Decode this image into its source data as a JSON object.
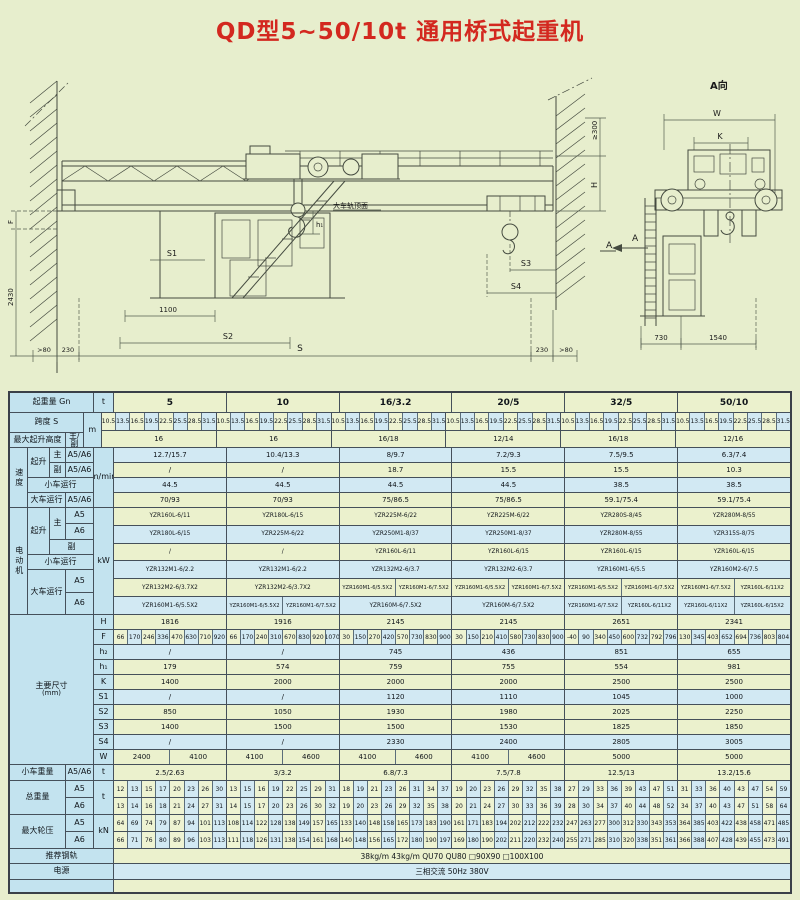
{
  "title": "QD型5~50/10t 通用桥式起重机",
  "drawing": {
    "main": {
      "f": "F",
      "v2430": "2430",
      "s1": "S1",
      "v1100": "1100",
      "s2": "S2",
      "gt80L": ">80",
      "v230L": "230",
      "span": "S",
      "v230R": "230",
      "gt80R": ">80",
      "ge300": "≥300",
      "h": "H",
      "h1": "h₁",
      "s3": "S3",
      "s4": "S4",
      "railTop": "大车轨顶面",
      "arrowA": "A"
    },
    "side": {
      "title": "A向",
      "w": "W",
      "k": "K",
      "v730": "730",
      "v1540": "1540",
      "a": "A"
    }
  },
  "table": {
    "labels": {
      "capacity": "起重量 Gn",
      "span": "跨度 S",
      "liftHeight": "最大起升高度",
      "mainAux": "主/副",
      "speedGroup": "速度",
      "hoist": "起升",
      "main": "主",
      "aux": "副",
      "a5a6": "A5/A6",
      "trolleyRun": "小车运行",
      "craneRun": "大车运行",
      "motorGroup": "电动机",
      "a5": "A5",
      "a6": "A6",
      "dimsGroup": "主要尺寸",
      "dimsUnit": "(mm)",
      "dims": [
        "H",
        "F",
        "h₂",
        "h₁",
        "K",
        "S1",
        "S2",
        "S3",
        "S4",
        "W"
      ],
      "trolleyWeight": "小车重量",
      "totalWeight": "总重量",
      "wheelLoad": "最大轮压",
      "rail": "推荐钢轨",
      "power": "电源"
    },
    "units": {
      "capacity": "t",
      "span": "m",
      "speed": "m/min",
      "motor": "kW",
      "trolleyWeight": "t",
      "totalWeight": "t",
      "wheelLoad": "kN"
    },
    "col_headers": [
      "5",
      "10",
      "16/3.2",
      "20/5",
      "32/5",
      "50/10"
    ],
    "spans": [
      [
        "10.5",
        "13.5",
        "16.5",
        "19.5",
        "22.5",
        "25.5",
        "28.5",
        "31.5"
      ],
      [
        "10.5",
        "13.5",
        "16.5",
        "19.5",
        "22.5",
        "25.5",
        "28.5",
        "31.5"
      ],
      [
        "10.5",
        "13.5",
        "16.5",
        "19.5",
        "22.5",
        "25.5",
        "28.5",
        "31.5"
      ],
      [
        "10.5",
        "13.5",
        "16.5",
        "19.5",
        "22.5",
        "25.5",
        "28.5",
        "31.5"
      ],
      [
        "10.5",
        "13.5",
        "16.5",
        "19.5",
        "22.5",
        "25.5",
        "28.5",
        "31.5"
      ],
      [
        "10.5",
        "13.5",
        "16.5",
        "19.5",
        "22.5",
        "25.5",
        "28.5",
        "31.5"
      ]
    ],
    "lift_height": [
      "16",
      "16",
      "16/18",
      "12/14",
      "16/18",
      "12/16"
    ],
    "speed_main": [
      "12.7/15.7",
      "10.4/13.3",
      "8/9.7",
      "7.2/9.3",
      "7.5/9.5",
      "6.3/7.4"
    ],
    "speed_aux": [
      "/",
      "/",
      "18.7",
      "15.5",
      "15.5",
      "10.3"
    ],
    "speed_trolley": [
      "44.5",
      "44.5",
      "44.5",
      "44.5",
      "38.5",
      "38.5"
    ],
    "speed_crane": [
      "70/93",
      "70/93",
      "75/86.5",
      "75/86.5",
      "59.1/75.4",
      "59.1/75.4"
    ],
    "motor_main_a5": [
      "YZR160L-6/11",
      "YZR180L-6/15",
      "YZR225M-6/22",
      "YZR225M-6/22",
      "YZR280S-8/45",
      "YZR280M-8/55"
    ],
    "motor_main_a6": [
      "YZR180L-6/15",
      "YZR225M-6/22",
      "YZR250M1-8/37",
      "YZR250M1-8/37",
      "YZR280M-8/55",
      "YZR315S-8/75"
    ],
    "motor_aux": [
      "/",
      "/",
      "YZR160L-6/11",
      "YZR160L-6/15",
      "YZR160L-6/15",
      "YZR160L-6/15"
    ],
    "motor_trolley": [
      "YZR132M1-6/2.2",
      "YZR132M1-6/2.2",
      "YZR132M2-6/3.7",
      "YZR132M2-6/3.7",
      "YZR160M1-6/5.5",
      "YZR160M2-6/7.5"
    ],
    "motor_crane_a5": [
      "YZR132M2-6/3.7X2",
      "YZR132M2-6/3.7X2",
      [
        "YZR160M1-6/5.5X2",
        "YZR160M1-6/7.5X2"
      ],
      [
        "YZR160M1-6/5.5X2",
        "YZR160M1-6/7.5X2"
      ],
      [
        "YZR160M1-6/5.5X2",
        "YZR160M1-6/7.5X2"
      ],
      [
        "YZR160M1-6/7.5X2",
        "YZR160L-6/11X2"
      ]
    ],
    "motor_crane_a6": [
      "YZR160M1-6/5.5X2",
      [
        "YZR160M1-6/5.5X2",
        "YZR160M1-6/7.5X2"
      ],
      "YZR160M-6/7.5X2",
      "YZR160M-6/7.5X2",
      [
        "YZR160M1-6/7.5X2",
        "YZR160L-6/11X2"
      ],
      [
        "YZR160L-6/11X2",
        "YZR160L-6/15X2"
      ]
    ],
    "dims": [
      [
        "1816",
        "1916",
        "2145",
        "2145",
        "2651",
        "2341"
      ],
      [
        [
          "66",
          "170",
          "246",
          "336",
          "470",
          "630",
          "710",
          "920"
        ],
        [
          "66",
          "170",
          "240",
          "310",
          "670",
          "830",
          "920",
          "1070"
        ],
        [
          "30",
          "150",
          "270",
          "420",
          "570",
          "730",
          "830",
          "900"
        ],
        [
          "30",
          "150",
          "210",
          "410",
          "580",
          "730",
          "830",
          "900"
        ],
        [
          "-40",
          "90",
          "340",
          "450",
          "600",
          "732",
          "792",
          "796"
        ],
        [
          "130",
          "345",
          "403",
          "652",
          "694",
          "736",
          "803",
          "804"
        ]
      ],
      [
        "/",
        "/",
        "745",
        "436",
        "851",
        "655"
      ],
      [
        "179",
        "574",
        "759",
        "755",
        "554",
        "981"
      ],
      [
        "1400",
        "2000",
        "2000",
        "2000",
        "2500",
        "2500"
      ],
      [
        "/",
        "/",
        "1120",
        "1110",
        "1045",
        "1000"
      ],
      [
        "850",
        "1050",
        "1930",
        "1980",
        "2025",
        "2250"
      ],
      [
        "1400",
        "1500",
        "1500",
        "1530",
        "1825",
        "1850"
      ],
      [
        "/",
        "/",
        "2330",
        "2400",
        "2805",
        "3005"
      ],
      [
        [
          "2400",
          "4100"
        ],
        [
          "4100",
          "4600"
        ],
        [
          "4100",
          "4600"
        ],
        [
          "4100",
          "4600"
        ],
        "5000",
        "5000"
      ]
    ],
    "trolley_weight": [
      "2.5/2.63",
      "3/3.2",
      "6.8/7.3",
      "7.5/7.8",
      "12.5/13",
      "13.2/15.6"
    ],
    "total_a5": [
      [
        "12",
        "13",
        "15",
        "17",
        "20",
        "23",
        "26",
        "30"
      ],
      [
        "13",
        "15",
        "16",
        "19",
        "22",
        "25",
        "29",
        "31"
      ],
      [
        "18",
        "19",
        "21",
        "23",
        "26",
        "31",
        "34",
        "37"
      ],
      [
        "19",
        "20",
        "23",
        "26",
        "29",
        "32",
        "35",
        "38"
      ],
      [
        "27",
        "29",
        "33",
        "36",
        "39",
        "43",
        "47",
        "51"
      ],
      [
        "31",
        "33",
        "36",
        "40",
        "43",
        "47",
        "54",
        "59"
      ]
    ],
    "total_a6": [
      [
        "13",
        "14",
        "16",
        "18",
        "21",
        "24",
        "27",
        "31"
      ],
      [
        "14",
        "15",
        "17",
        "20",
        "23",
        "26",
        "30",
        "32"
      ],
      [
        "19",
        "20",
        "23",
        "26",
        "29",
        "32",
        "35",
        "38"
      ],
      [
        "20",
        "21",
        "24",
        "27",
        "30",
        "33",
        "36",
        "39"
      ],
      [
        "28",
        "30",
        "34",
        "37",
        "40",
        "44",
        "48",
        "52"
      ],
      [
        "34",
        "37",
        "40",
        "43",
        "47",
        "51",
        "58",
        "64"
      ]
    ],
    "wheel_a5": [
      [
        "64",
        "69",
        "74",
        "79",
        "87",
        "94",
        "101",
        "113"
      ],
      [
        "108",
        "114",
        "122",
        "128",
        "138",
        "149",
        "157",
        "165"
      ],
      [
        "133",
        "140",
        "148",
        "158",
        "165",
        "173",
        "183",
        "190"
      ],
      [
        "161",
        "171",
        "183",
        "194",
        "202",
        "212",
        "222",
        "232"
      ],
      [
        "247",
        "263",
        "277",
        "300",
        "312",
        "330",
        "343",
        "353"
      ],
      [
        "364",
        "385",
        "403",
        "422",
        "438",
        "458",
        "471",
        "485"
      ]
    ],
    "wheel_a6": [
      [
        "66",
        "71",
        "76",
        "80",
        "89",
        "96",
        "103",
        "113"
      ],
      [
        "111",
        "118",
        "126",
        "131",
        "138",
        "154",
        "161",
        "168"
      ],
      [
        "140",
        "148",
        "156",
        "165",
        "172",
        "180",
        "190",
        "197"
      ],
      [
        "169",
        "180",
        "190",
        "202",
        "211",
        "220",
        "232",
        "240"
      ],
      [
        "255",
        "271",
        "285",
        "310",
        "320",
        "338",
        "351",
        "361"
      ],
      [
        "366",
        "388",
        "407",
        "428",
        "439",
        "455",
        "473",
        "491"
      ]
    ],
    "rail_text": "38kg/m   43kg/m   QU70   QU80   □90X90   □100X100",
    "power_text": "三相交流   50Hz   380V"
  }
}
